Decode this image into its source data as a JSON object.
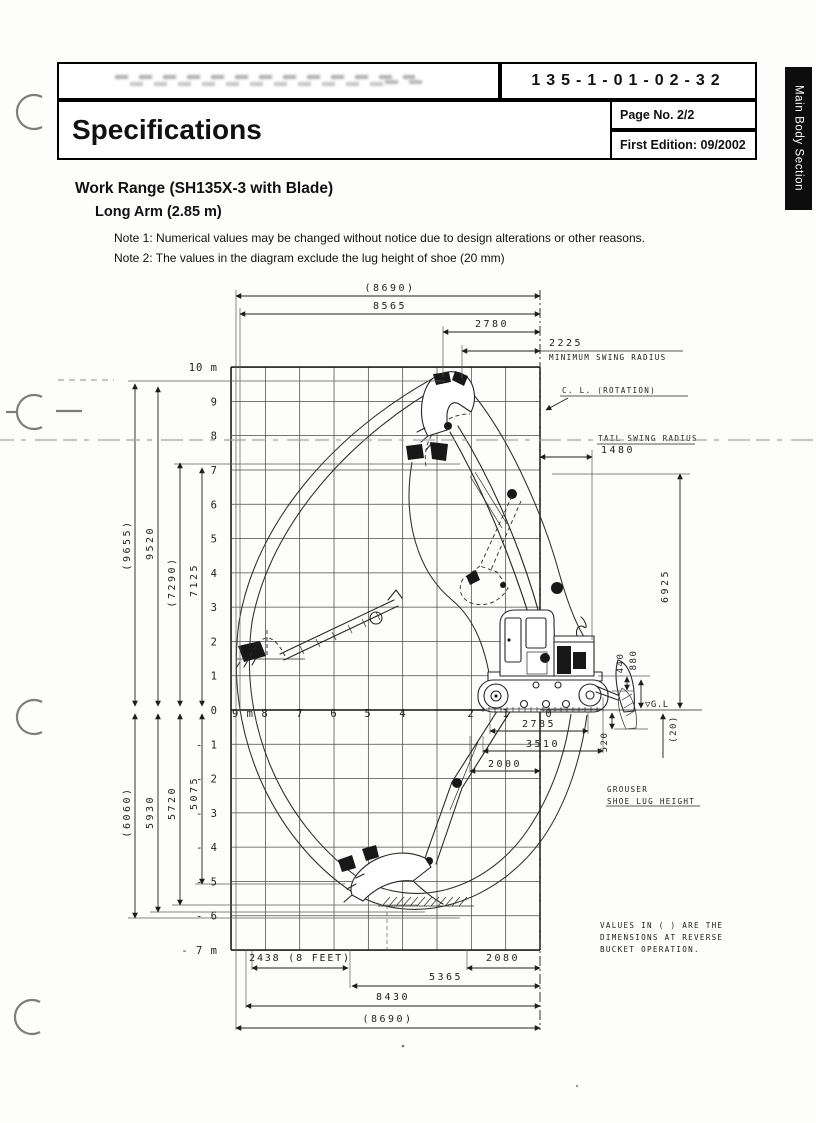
{
  "header": {
    "doc_number": "135-1-01-02-32",
    "title": "Specifications",
    "page_no": "Page No. 2/2",
    "edition": "First Edition: 09/2002"
  },
  "side_tab": {
    "label": "Main Body Section"
  },
  "body": {
    "heading": "Work Range (SH135X-3 with Blade)",
    "subheading": "Long Arm (2.85 m)",
    "note1": "Note 1: Numerical values may be changed without notice due to design alterations or other reasons.",
    "note2": "Note 2: The values in the diagram exclude the lug height of shoe (20 mm)"
  },
  "diagram": {
    "top": {
      "overall_paren": "(8690)",
      "overall": "8565",
      "reach_2780": "2780",
      "min_swing_value": "2225",
      "min_swing_label": "MINIMUM SWING RADIUS",
      "cl_rotation": "C. L. (ROTATION)",
      "tail_swing_label": "TAIL SWING RADIUS",
      "tail_swing_value": "1480"
    },
    "left_upper": {
      "h_paren": "(9655)",
      "h": "9520",
      "d_paren": "(7290)",
      "d": "7125"
    },
    "left_lower": {
      "a_paren": "(6060)",
      "a": "5930",
      "b": "5720",
      "c": "5075"
    },
    "right": {
      "boom_height": "6925",
      "blade_440": "440",
      "blade_880": "880",
      "gl": "▽G.L",
      "lug_20": "(20)",
      "blade_drop_520": "520",
      "grouser1": "GROUSER",
      "grouser2": "SHOE LUG HEIGHT"
    },
    "machine": {
      "tumbler": "2785",
      "crawler": "3510",
      "width_2000": "2000"
    },
    "bottom": {
      "feet": "2438 (8 FEET)",
      "r2080": "2080",
      "r5365": "5365",
      "r8430": "8430",
      "overall_paren": "(8690)"
    },
    "note_box": {
      "l1": "VALUES IN ( ) ARE THE",
      "l2": "DIMENSIONS AT REVERSE",
      "l3": "BUCKET OPERATION."
    },
    "axis": {
      "y_labels": [
        "10 m",
        "9",
        "8",
        "7",
        "6",
        "5",
        "4",
        "3",
        "2",
        "1",
        "0",
        "- 1",
        "- 2",
        "- 3",
        "- 4",
        "- 5",
        "- 6",
        "- 7 m"
      ],
      "x_labels": [
        "9 m",
        "8",
        "7",
        "6",
        "5",
        "4",
        "2",
        "1",
        "0"
      ]
    }
  }
}
